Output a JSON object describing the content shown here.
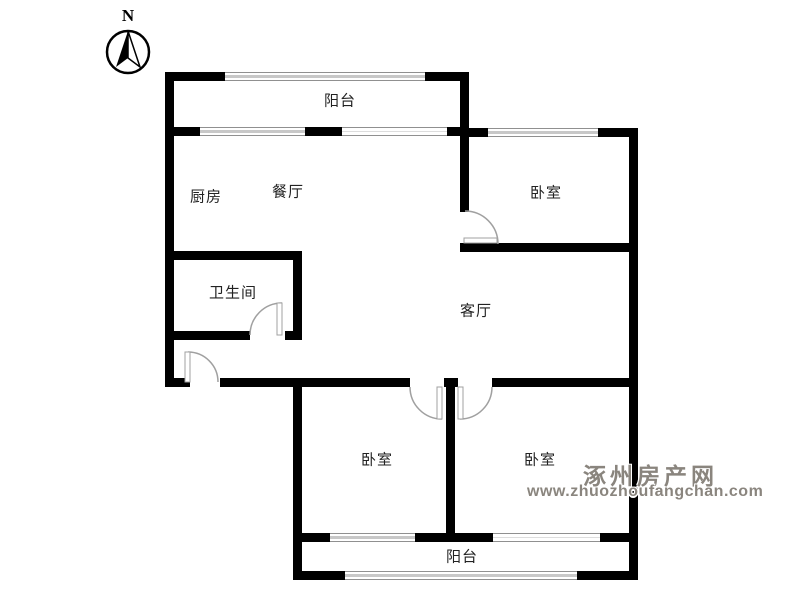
{
  "compass": {
    "label": "N"
  },
  "rooms": [
    {
      "id": "balcony-top",
      "label": "阳台"
    },
    {
      "id": "kitchen",
      "label": "厨房"
    },
    {
      "id": "dining",
      "label": "餐厅"
    },
    {
      "id": "bedroom-ne",
      "label": "卧室"
    },
    {
      "id": "bathroom",
      "label": "卫生间"
    },
    {
      "id": "living",
      "label": "客厅"
    },
    {
      "id": "bedroom-sw",
      "label": "卧室"
    },
    {
      "id": "bedroom-se",
      "label": "卧室"
    },
    {
      "id": "balcony-bottom",
      "label": "阳台"
    }
  ],
  "watermark": {
    "site_name": "涿州房产网",
    "site_url": "www.zhuozhoufangchan.com"
  },
  "colors": {
    "wall": "#000000",
    "window": "#909090",
    "windowmid": "#c8c8c8",
    "door": "#a0a0a0",
    "label": "#222222",
    "watermark": "#8a857e",
    "bg": "#ffffff"
  }
}
